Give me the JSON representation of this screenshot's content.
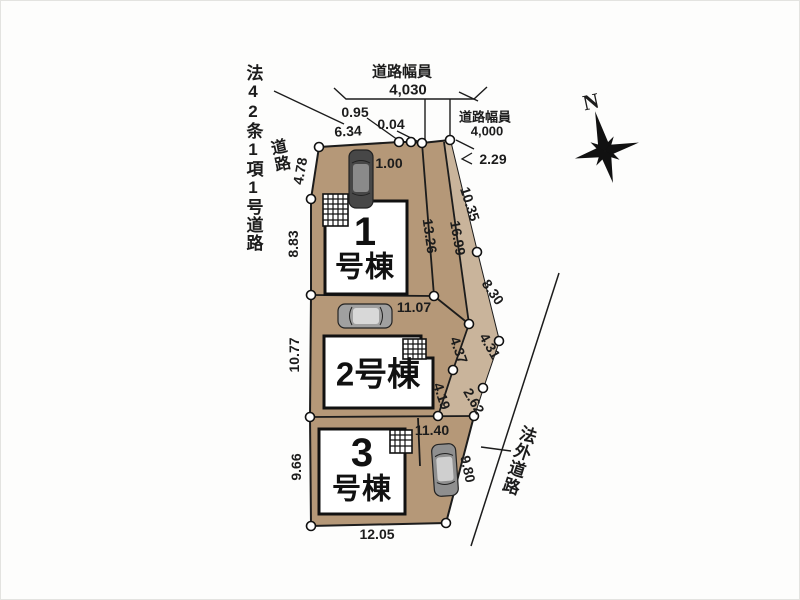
{
  "plan": {
    "title_hint": "housing site plan",
    "colors": {
      "parcel": "#b59878",
      "driveway_strip": "#c9b49b",
      "building_fill": "#ffffff",
      "line": "#1c1c1c"
    },
    "buildings": {
      "b1_num": "1",
      "b1_suffix": "号棟",
      "b2_label": "2号棟",
      "b3_num": "3",
      "b3_suffix": "号棟"
    },
    "dims": [
      "4.78",
      "6.34",
      "0.95",
      "0.04",
      "1.00",
      "8.83",
      "10.77",
      "9.66",
      "13.26",
      "16.99",
      "10.35",
      "8.30",
      "2.29",
      "4.37",
      "4.31",
      "4.19",
      "2.62",
      "9.80",
      "11.07",
      "11.40",
      "12.05"
    ],
    "roads": {
      "width_caption_top": "道路幅員",
      "width_value_top": "4,030",
      "width_caption_right": "道路幅員",
      "width_value_right": "4,000",
      "designation": "法42条1項1号道路",
      "road_word": "道路",
      "outside_road": "法外道路"
    },
    "compass": {
      "north": "N"
    }
  }
}
